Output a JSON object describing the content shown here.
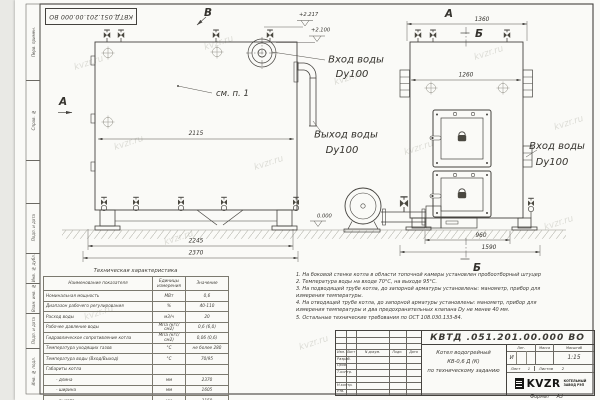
{
  "watermark": "kvzr.ru",
  "frame": {
    "top_stamp": "КВТД.051.201.00.000 ВО",
    "margin_labels": [
      "Перв. примен.",
      "Справ. №",
      "Подп. и дата",
      "Инв. № дубл.",
      "Взам. инв. №",
      "Подп. и дата",
      "Инв. № подл."
    ],
    "format_label": "Формат",
    "format_value": "А3"
  },
  "drawing": {
    "labels": {
      "v": "В",
      "a": "А",
      "b": "Б",
      "see_item": "см. п. 1"
    },
    "elevations": {
      "top": "+2.217",
      "mid": "+2.100",
      "zero": "0.000"
    },
    "dims": {
      "d2115": "2115",
      "d2245": "2245",
      "d2370": "2370",
      "d1360": "1360",
      "d1260": "1260",
      "d960": "960",
      "d1590": "1590"
    },
    "pipes": {
      "inlet": "Вход воды",
      "outlet": "Выход воды",
      "dn": "Dy100"
    }
  },
  "spec_table": {
    "title": "Техническая характеристика",
    "col_name": "Наименование показателя",
    "col_units": "Единицы измерения",
    "col_value": "Значение",
    "rows": [
      {
        "name": "Номинальная мощность",
        "units": "МВт",
        "value": "0,6"
      },
      {
        "name": "Диапазон рабочего регулирования",
        "units": "%",
        "value": "40-110"
      },
      {
        "name": "Расход воды",
        "units": "м3/ч",
        "value": "20"
      },
      {
        "name": "Рабочее давление воды",
        "units": "МПа (кгс/см2)",
        "value": "0,6 (6,0)"
      },
      {
        "name": "Гидравлическое сопротивление котла",
        "units": "МПа (кгс/см2)",
        "value": "0,06 (0,6)"
      },
      {
        "name": "Температура уходящих газов",
        "units": "°С",
        "value": "не более 280"
      },
      {
        "name": "Температура воды (Вход/Выход)",
        "units": "°С",
        "value": "70/95"
      },
      {
        "name": "Габариты котла",
        "units": "",
        "value": ""
      },
      {
        "name": "- длина",
        "units": "мм",
        "value": "2370"
      },
      {
        "name": "- ширина",
        "units": "мм",
        "value": "1605"
      },
      {
        "name": "- высота",
        "units": "мм",
        "value": "2150"
      }
    ]
  },
  "notes": [
    "1. На боковой стенке котла в области топочной камеры установлен пробоотборный штуцер",
    "2. Температура воды на входе 70°С, на выходе 95°С.",
    "3. На подводящей трубе котла, до запорной арматуры установлены: манометр, прибор для измерения температуры.",
    "4. На отводящей трубе котла, до запорной арматуры установлены: манометр, прибор для измерения температуры и два предохранительных клапана Dу не менее 40 мм.",
    "5. Остальные технические требования по ОСТ 108.030.133-84."
  ],
  "title_block": {
    "doc_number": "КВТД .051.201.00.000  ВО",
    "header_cols": [
      "Изм.",
      "Лист",
      "N докум.",
      "Подп.",
      "Дата"
    ],
    "sign_rows": [
      "Разраб.",
      "Пров.",
      "Т.контр.",
      "",
      "Н.контр.",
      "Утв."
    ],
    "product": {
      "l1": "Котел водогрейный",
      "l2": "КВ-0,6  Д  (К)",
      "l3": "по техническому заданию"
    },
    "lit_label": "Лит.",
    "mass_label": "Масса",
    "scale_label": "Масштаб",
    "lit_value": "И",
    "scale_value": "1:15",
    "sheet_line": {
      "sheet_label": "Лист",
      "sheet_value": "1",
      "sheets_label": "Листов",
      "sheets_value": "2"
    },
    "logo_text": "KVZR",
    "company": {
      "l1": "КОТЕЛЬНЫЙ",
      "l2": "ЗАВОД РЭП"
    }
  }
}
